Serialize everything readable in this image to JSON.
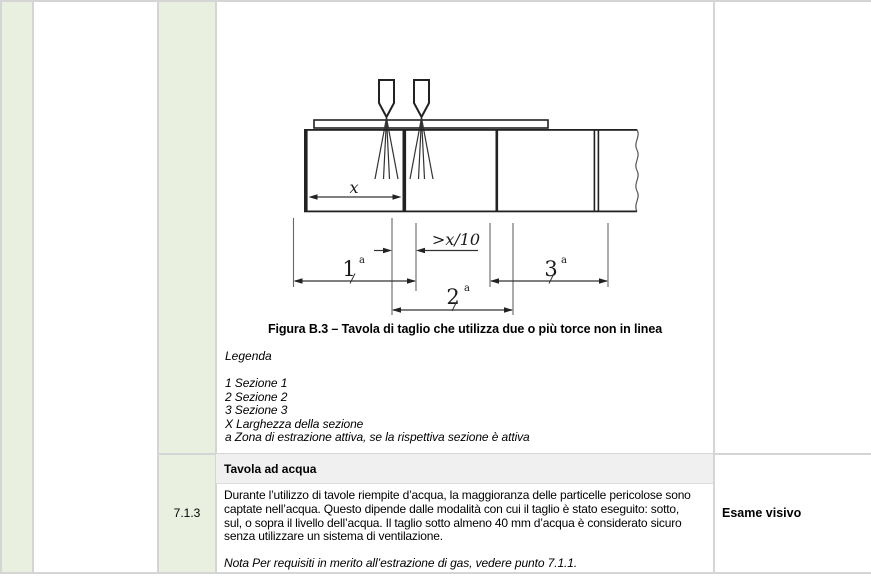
{
  "document": {
    "figure": {
      "caption": "Figura B.3 – Tavola di taglio che utilizza due o più torce non in linea",
      "legend_title": "Legenda",
      "legend_items": [
        "1 Sezione 1",
        "2 Sezione 2",
        "3 Sezione 3",
        "X Larghezza della sezione",
        "a Zona di estrazione attiva, se la rispettiva sezione è attiva"
      ],
      "diagram_labels": {
        "section_width": "x",
        "torch_offset": ">x/10",
        "zone1_num": "1",
        "zone2_num": "2",
        "zone3_num": "3",
        "zone_footnote": "a"
      }
    },
    "clause": {
      "number": "7.1.3",
      "title": "Tavola ad acqua",
      "body_lines": [
        "Durante l’utilizzo di tavole riempite d’acqua, la maggioranza delle particelle pericolose sono",
        "captate nell’acqua. Questo dipende dalle modalità con cui il taglio è stato eseguito: sotto,",
        "sul, o sopra il livello dell’acqua. Il taglio sotto almeno 40 mm d’acqua è considerato sicuro",
        "senza utilizzare un sistema di ventilazione."
      ],
      "note": "Nota Per requisiti in merito all’estrazione di gas, vedere punto 7.1.1.",
      "verification": "Esame visivo"
    },
    "colors": {
      "accent_green": "#e9f0e0",
      "band_gray": "#f0f0f0",
      "border_gray": "#d5d5d5",
      "diagram_line": "#1a1a1a"
    }
  }
}
